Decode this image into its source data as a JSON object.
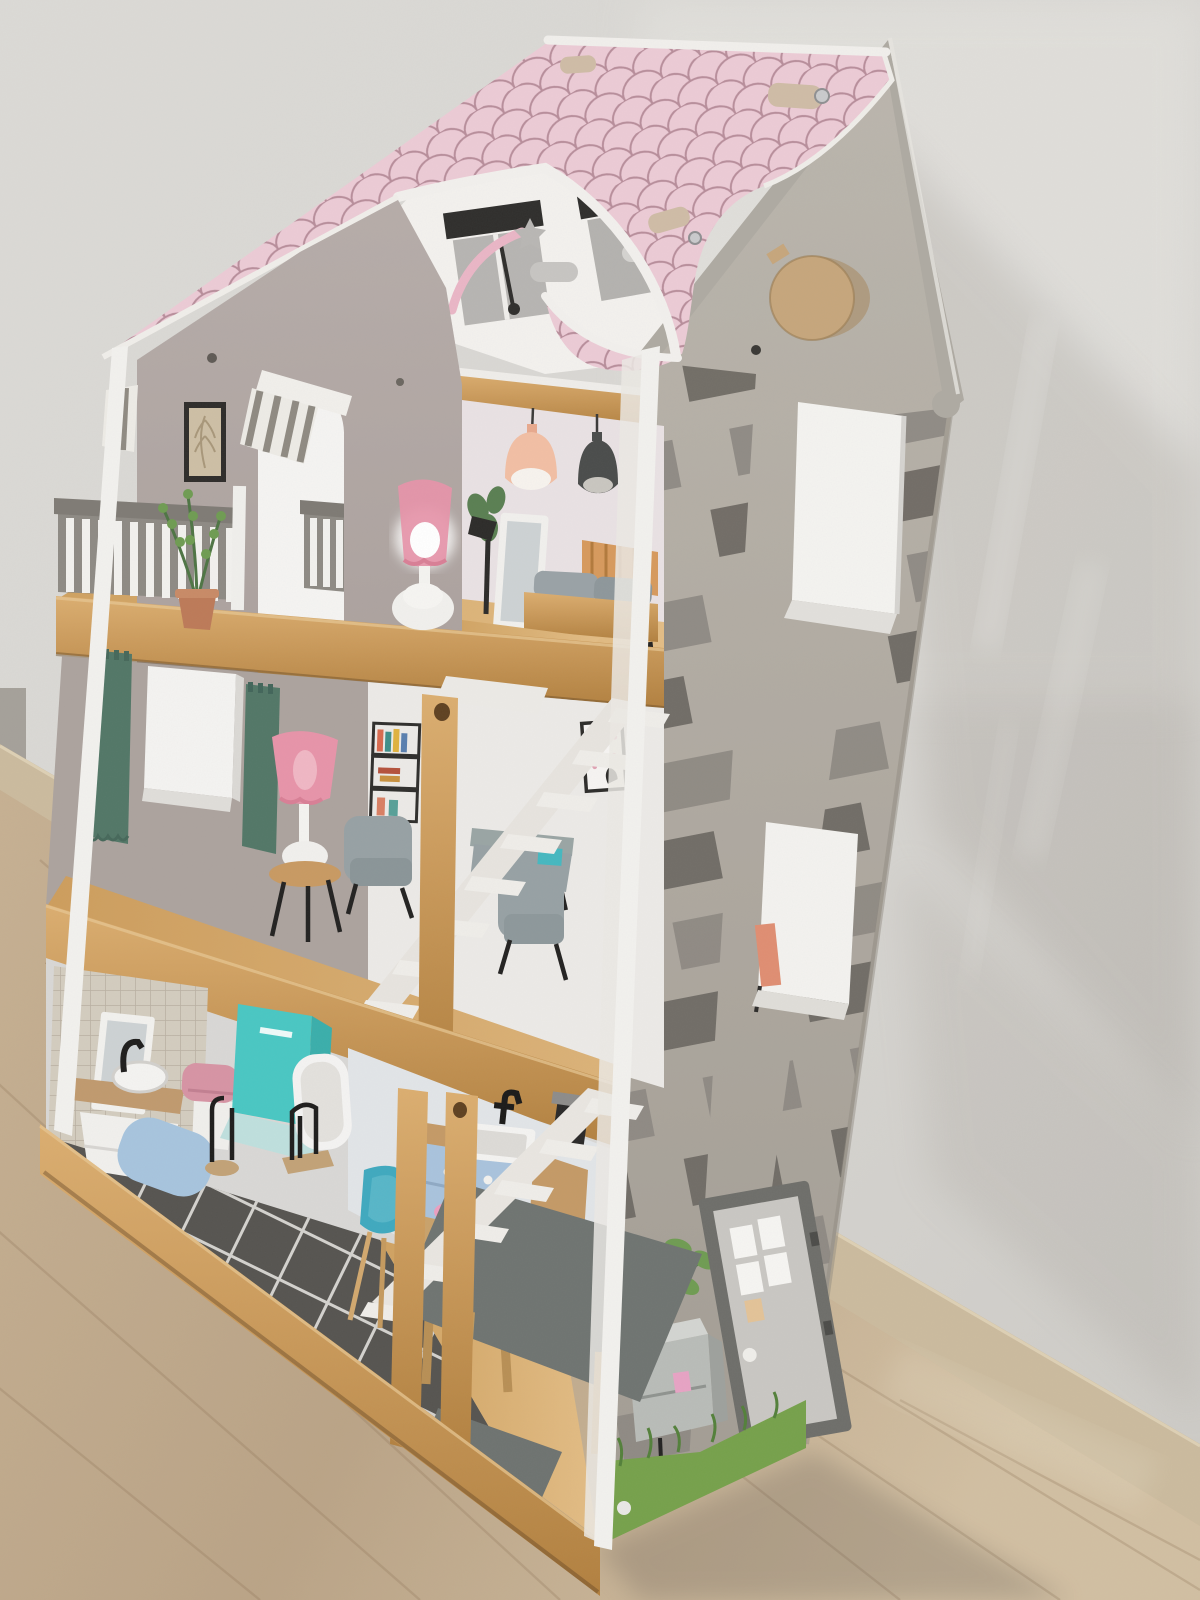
{
  "scene": {
    "type": "photograph",
    "description": "Three-storey wooden toy dollhouse with a pink scalloped roof, grey brick-decal side wall, open front showing a bedroom, living room, bathroom and kitchen, standing on a light wooden floor against a white textured wall",
    "palette": {
      "wall_bg": "#d9d7d3",
      "wall_bright": "#e6e5e1",
      "wall_shadow": "#8d867f",
      "floor_wood": "#c4ae90",
      "floor_shadow": "#6e6359",
      "baseboard": "#cbbb9e",
      "house_edge_white": "#f2f1ee",
      "side_wall": "#b3ada4",
      "brick_dark": "#6e6a64",
      "brick_mid": "#8e8983",
      "roof_pink": "#eccbd6",
      "roof_scallop_line": "#b88e9b",
      "shingle_beige": "#cfbca6",
      "attic_white": "#f3f1ee",
      "gable_taupe": "#b2a8a4",
      "bedroom_wall": "#e9e2e4",
      "mid_wall_taupe": "#aca39e",
      "mid_wall_white": "#eceae7",
      "wood_slab": "#c89455",
      "wood_light": "#d9ab6e",
      "railing_gray": "#8e8a84",
      "curtain_teal": "#527767",
      "sofa_gray": "#97a1a4",
      "lamp_pink": "#e794a9",
      "pendant_peach": "#f2bfa4",
      "pendant_gray": "#4a4c4b",
      "tile_floor": "#565450",
      "mosaic_tile": "#d3ccbf",
      "rug_blue": "#a7c4de",
      "toilet_pink": "#d794a4",
      "shower_teal": "#49c7c3",
      "tub_white": "#f4f3f2",
      "cabinet_blue": "#a9c3dd",
      "chair_teal": "#3fa9bf",
      "table_gray": "#6f7471",
      "door_gray": "#c9c7c3",
      "door_frame": "#6e6e6a",
      "mailbox_gray": "#b9bcb8",
      "mailbox_flag_pink": "#e7a3c4",
      "grass_green": "#76a14b",
      "plant_green": "#6f9c52",
      "pot_terracotta": "#bd7a58",
      "porthole_tan": "#c6a67c",
      "mirror_glass": "#cdd2d4",
      "stair_white": "#efede9",
      "black_detail": "#232221"
    },
    "objects": [
      "pink scalloped roof with arched cut-out",
      "attic ceiling with skylight and shooting-star decals",
      "round wooden porthole shutter",
      "grey side wall with brick decals",
      "two white cut-out windows on side wall",
      "grey front-door decal with mailbox, plant and grass decals",
      "top-floor bedroom: pendant-lamp decals, standing mirror, bed, low table, glowing pink lamp",
      "front gable wall with framed picture and arched doorway with striped awning",
      "balcony with grey and white railing and potted plant",
      "middle-floor living room: teal curtains, white window, pink floor lamp on stool, grey armchairs, bookshelf decal, dotted picture",
      "white zig-zag staircases",
      "ground-floor bathroom: mosaic wall, dark tiled floor, vanity with mirror, pink toilet, teal shower, white tub, blue rug, towel stands",
      "ground-floor kitchen: blue cabinet, sink with black faucet, grey table, teal chair, pink bowl",
      "wooden structural posts",
      "light wooden room floor and baseboard",
      "white stucco wall with soft house shadow"
    ]
  }
}
